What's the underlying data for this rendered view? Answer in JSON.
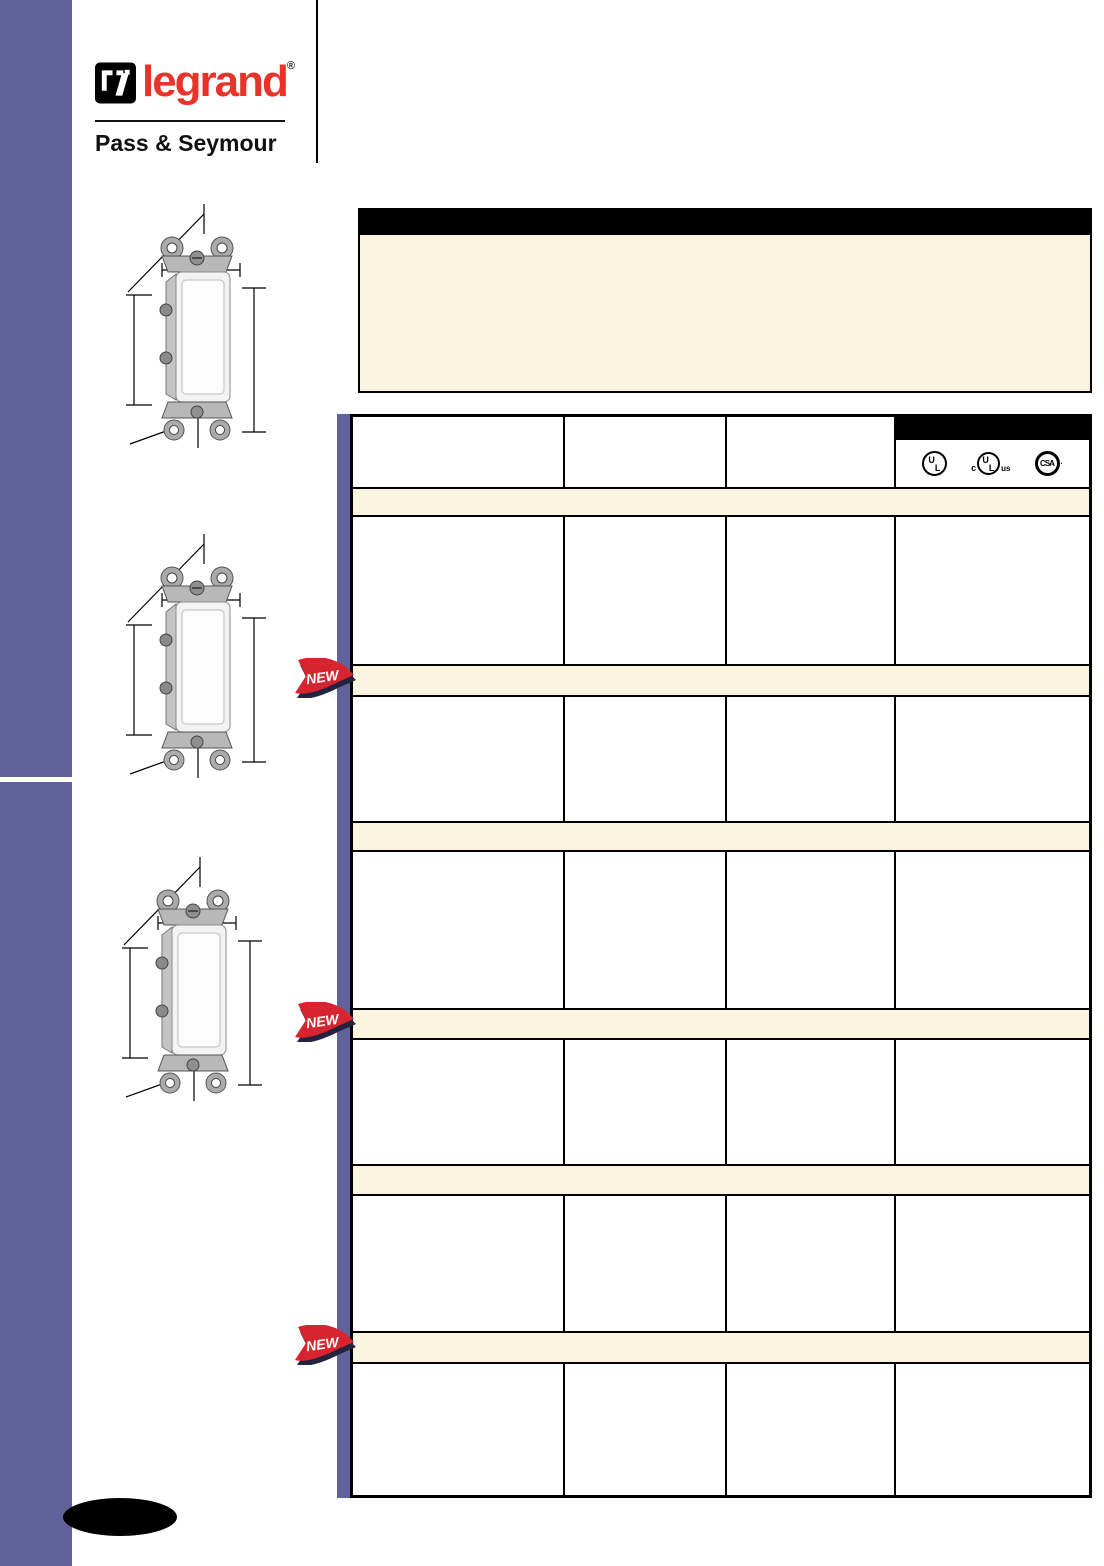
{
  "brand": {
    "logo_text": "legrand",
    "registered": "®",
    "subbrand": "Pass & Seymour"
  },
  "colors": {
    "sidebar_purple": "#62629A",
    "cream": "#FBF4DE",
    "legrand_red": "#E8332A",
    "badge_red": "#D6252E",
    "badge_shadow": "#23233F",
    "table_border": "#000000"
  },
  "title_bar": {
    "text": ""
  },
  "info_box": {
    "text": ""
  },
  "table": {
    "header": {
      "columns": [
        "",
        "",
        "",
        ""
      ],
      "cert_icons": [
        {
          "name": "ul-listed",
          "letters": [
            "U",
            "L"
          ],
          "prefix": "",
          "suffix": ""
        },
        {
          "name": "cul-us-listed",
          "letters": [
            "U",
            "L"
          ],
          "prefix": "c",
          "suffix": "us"
        },
        {
          "name": "csa-certified",
          "label": "CSA",
          "suffix": "·"
        }
      ]
    },
    "sections": [
      {
        "label": "",
        "new": false,
        "row": [
          "",
          "",
          "",
          ""
        ]
      },
      {
        "label": "",
        "new": true,
        "row": [
          "",
          "",
          "",
          ""
        ]
      },
      {
        "label": "",
        "new": false,
        "row": [
          "",
          "",
          "",
          ""
        ]
      },
      {
        "label": "",
        "new": true,
        "row": [
          "",
          "",
          "",
          ""
        ]
      },
      {
        "label": "",
        "new": false,
        "row": [
          "",
          "",
          "",
          ""
        ]
      },
      {
        "label": "",
        "new": true,
        "row": [
          "",
          "",
          "",
          ""
        ]
      }
    ]
  },
  "badge": {
    "label": "NEW"
  },
  "page_tab": {
    "text": ""
  }
}
